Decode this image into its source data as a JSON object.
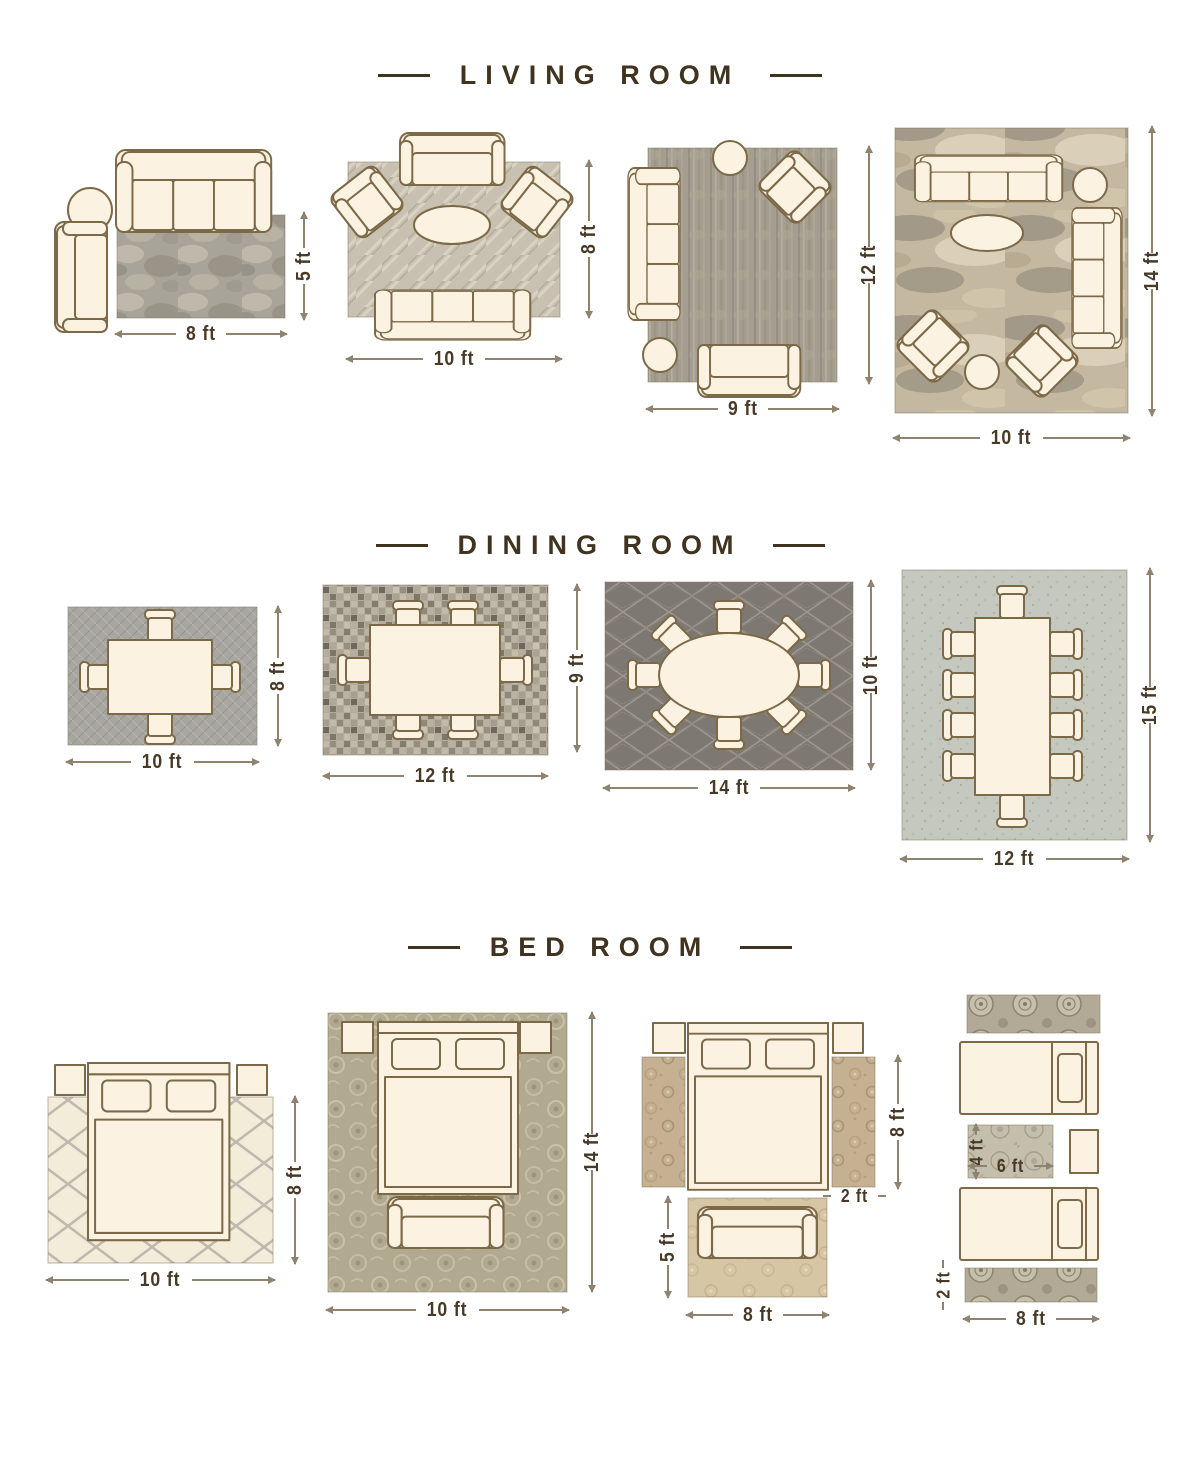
{
  "page": {
    "background": "#ffffff"
  },
  "colors": {
    "title_text": "#403320",
    "dimension_text": "#493a27",
    "dimension_line": "#8f8370",
    "furniture_fill": "#fbf2e2",
    "furniture_outline": "#7c6947"
  },
  "sections": [
    {
      "id": "living-room",
      "title": "LIVING ROOM",
      "layouts": [
        {
          "name": "sofa-and-side-chair",
          "width_label": "8 ft",
          "height_label": "5 ft"
        },
        {
          "name": "loveseat-two-armchairs-sofa",
          "width_label": "10 ft",
          "height_label": "8 ft"
        },
        {
          "name": "sofa-armchair-loveseat",
          "width_label": "9 ft",
          "height_label": "12 ft"
        },
        {
          "name": "two-sofas-two-armchairs",
          "width_label": "10 ft",
          "height_label": "14 ft"
        }
      ]
    },
    {
      "id": "dining-room",
      "title": "DINING ROOM",
      "layouts": [
        {
          "name": "table-four-chairs",
          "width_label": "10 ft",
          "height_label": "8 ft"
        },
        {
          "name": "table-six-chairs",
          "width_label": "12 ft",
          "height_label": "9 ft"
        },
        {
          "name": "oval-table-eight-chairs",
          "width_label": "14 ft",
          "height_label": "10 ft"
        },
        {
          "name": "long-table-ten-chairs",
          "width_label": "12 ft",
          "height_label": "15 ft"
        }
      ]
    },
    {
      "id": "bed-room",
      "title": "BED ROOM",
      "layouts": [
        {
          "name": "bed-on-lattice-rug",
          "width_label": "10 ft",
          "height_label": "8 ft"
        },
        {
          "name": "bed-bench-oversize-rug",
          "width_label": "10 ft",
          "height_label": "14 ft"
        },
        {
          "name": "bed-with-side-runners",
          "runner_height_label": "8 ft",
          "runner_width_label": "2 ft",
          "foot_rug_height_label": "5 ft",
          "foot_rug_width_label": "8 ft"
        },
        {
          "name": "twin-beds-with-runners",
          "accent_rug_height_label": "4 ft",
          "accent_rug_width_label": "6 ft",
          "runner_height_label": "2 ft",
          "runner_width_label": "8 ft"
        }
      ]
    }
  ]
}
